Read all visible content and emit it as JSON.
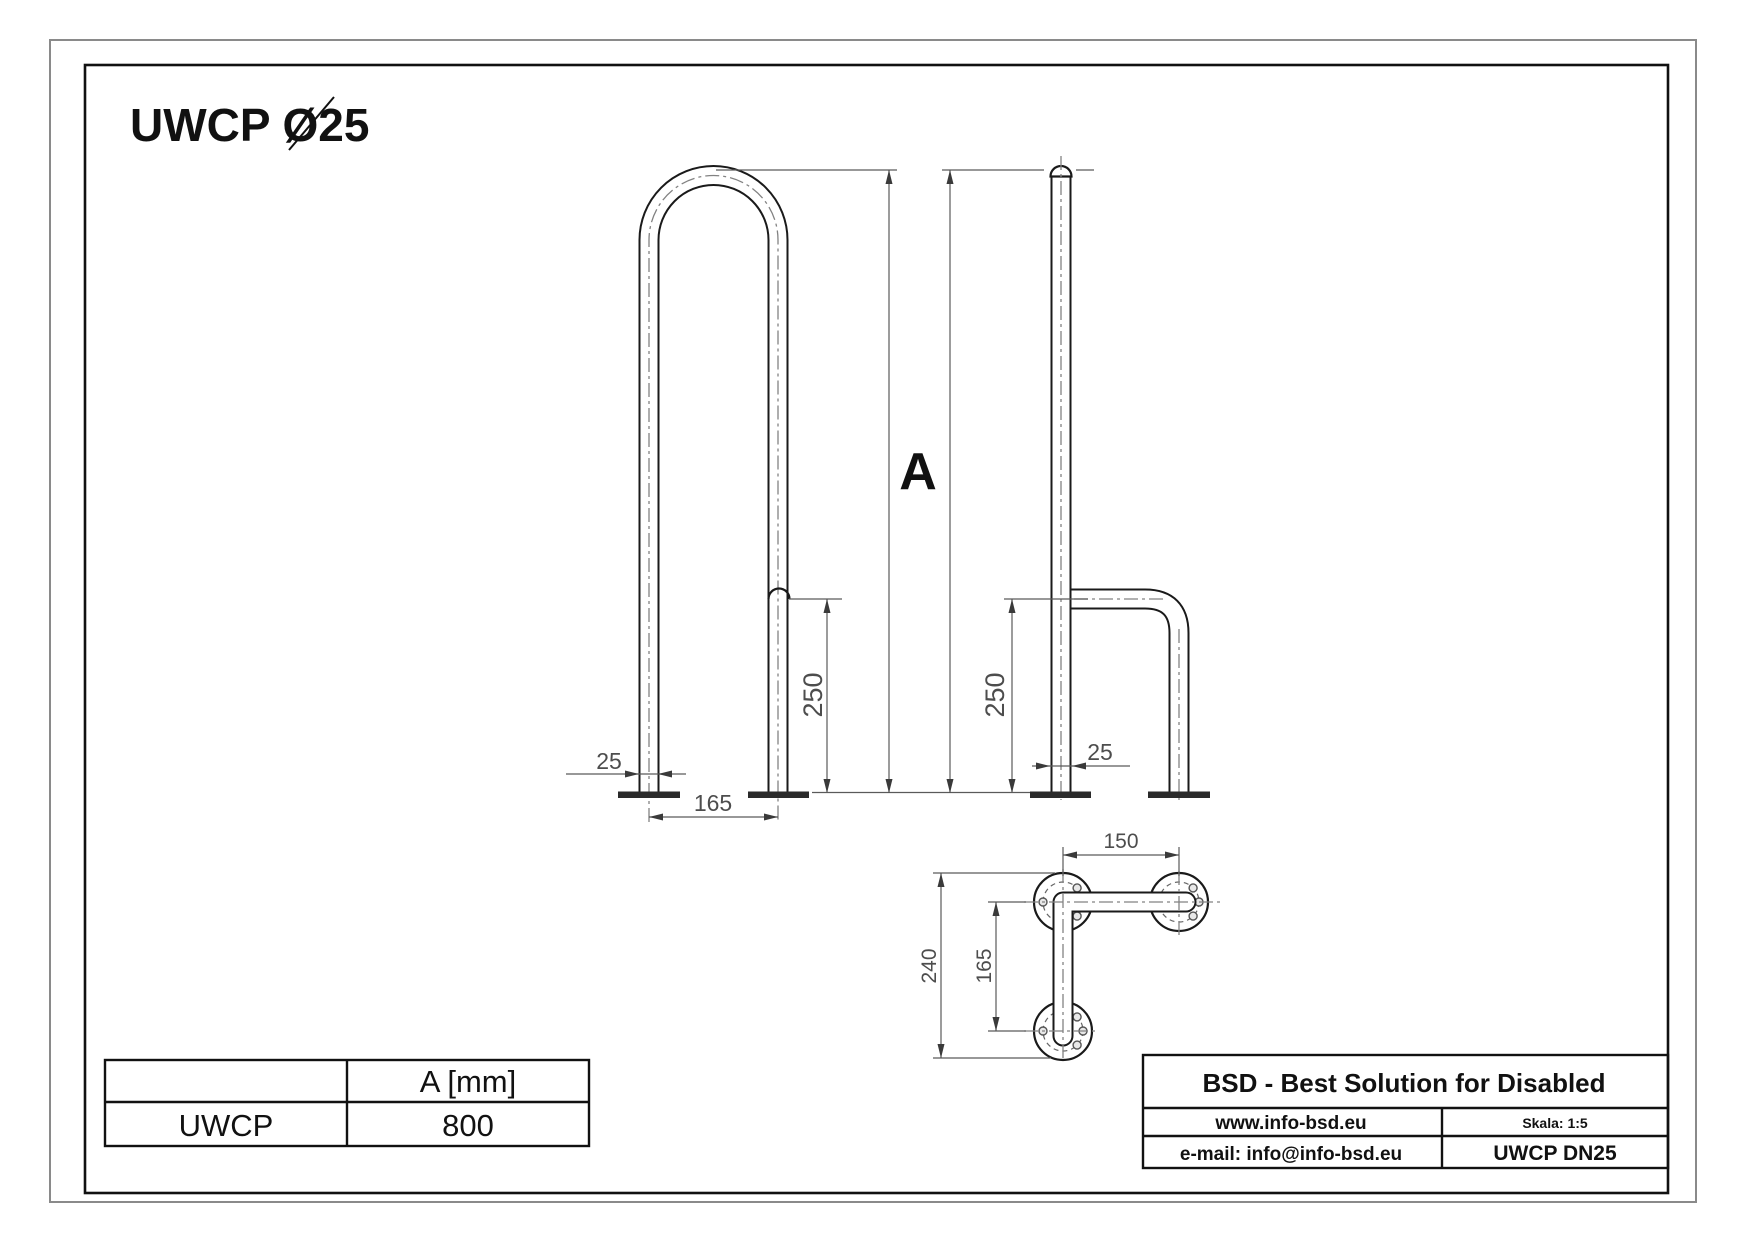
{
  "drawing_title": "UWCP Ø25",
  "dimensions": {
    "height_label": "A",
    "front_view": {
      "tube_diameter": "25",
      "base_spacing": "165",
      "support_height": "250"
    },
    "side_view": {
      "tube_diameter": "25",
      "support_height": "250"
    },
    "top_view": {
      "arm_offset": "150",
      "overall_depth": "240",
      "base_spacing": "165"
    }
  },
  "spec_table": {
    "header_col2": "A [mm]",
    "model": "UWCP",
    "value_a_mm": "800"
  },
  "title_block": {
    "company": "BSD - Best Solution for Disabled",
    "website": "www.info-bsd.eu",
    "scale_label": "Skala: 1:5",
    "email": "e-mail: info@info-bsd.eu",
    "product_code": "UWCP DN25"
  },
  "colors": {
    "outline": "#1a1a1a",
    "dimension_lines": "#5a5a5a",
    "centerline": "#828282",
    "background": "#ffffff"
  }
}
